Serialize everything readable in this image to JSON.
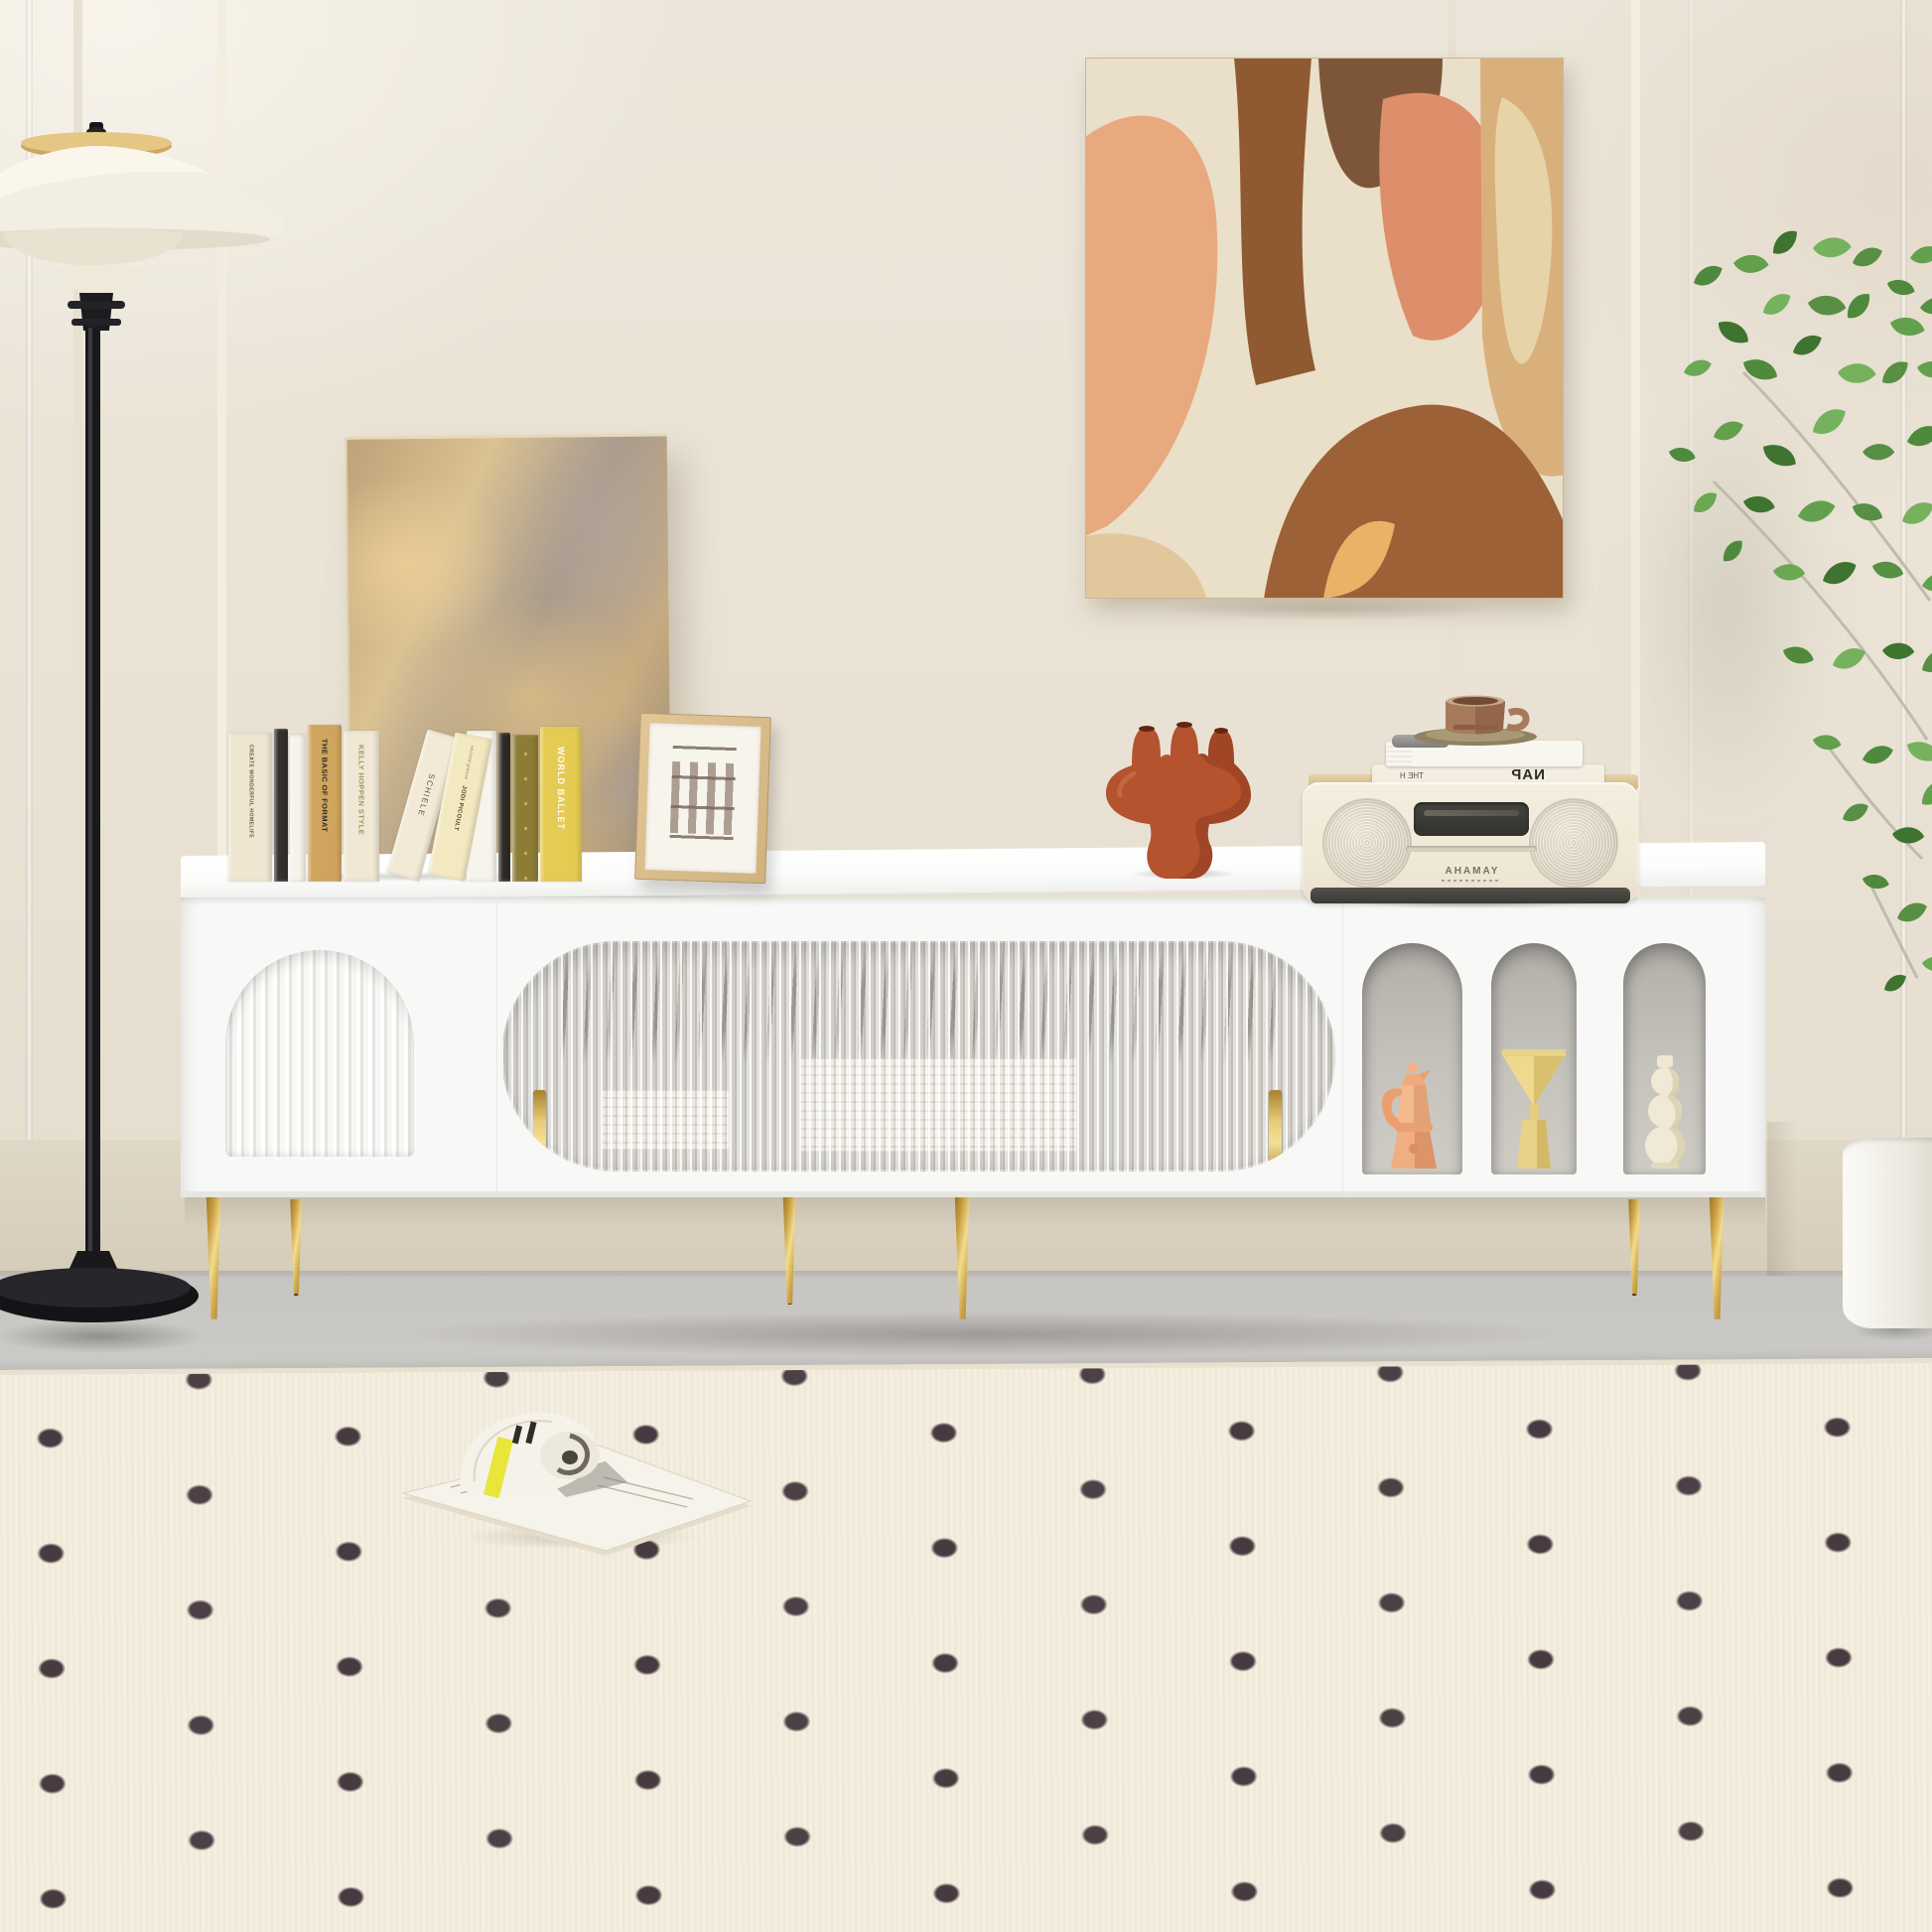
{
  "scene_label": "Bright living room with white TV stand, gold legs and styled decor",
  "palette": {
    "wall": "#eae3d6",
    "lower_wall": "#dbd2c1",
    "floor": "#cfcdc9",
    "rug": "#f3ecdc",
    "rug_dot": "#3e3138",
    "stand_white": "#f8f8f7",
    "gold": "#d3ab52",
    "reeded_glass": "#d2cfc9",
    "niche_grey": "#bcb9b3",
    "terracotta_vase": "#b4532e",
    "moka_peach": "#f2b186",
    "vase_yellow": "#e9d78e",
    "vase_cream": "#efe8d3",
    "plant_green": "#5d9a48",
    "lamp_black": "#1b1b1e",
    "lamp_shade_cream": "#f3eee2",
    "brass": "#c8a25a",
    "radio_cream": "#f2ecdc",
    "magazine_band": "#e9e432"
  },
  "books": [
    {
      "title": "CREATE WONDERFUL HOMELIFE",
      "color": "#efe6d2"
    },
    {
      "title": "",
      "color": "#34302c"
    },
    {
      "title": "",
      "color": "#f6f3ea"
    },
    {
      "title": "THE BASIC OF FORMAT",
      "color": "#cfa55e"
    },
    {
      "title": "KELLY HOPPEN STYLE",
      "color": "#f0e8d4"
    },
    {
      "title": "SCHIELE",
      "color": "#f2ead6"
    },
    {
      "title": "JODI PICOULT",
      "subtitle": "second glance",
      "color": "#f3e9c0"
    },
    {
      "title": "",
      "color": "#f7f4ec"
    },
    {
      "title": "",
      "color": "#2f2b27"
    },
    {
      "title": "",
      "color": "#8c7c35"
    },
    {
      "title": "WORLD BALLET",
      "color": "#e6cb52"
    }
  ],
  "radio": {
    "brand": "YAMAHA",
    "brand_mirrored": true,
    "stacked_books": [
      {
        "title": "NAP",
        "side_text": "THE H",
        "mirrored": true
      }
    ]
  },
  "frame": {
    "content": "architectural facade sketch"
  },
  "decor": {
    "terracotta_vase": "three-spout sculptural vase",
    "coffee_cup": "brown cup on saucer",
    "niche_items": [
      "moka pot",
      "triangle vase",
      "gourd vase"
    ],
    "magazine": "open magazine with yellow band",
    "plant": "leafy green tree",
    "planter": "white cylinder pot"
  },
  "tv_stand": {
    "finish": "white",
    "left_door": "fluted arch panel",
    "center_doors": "reeded glass with gold handles",
    "right_niches": 3,
    "legs": "gold tapered with black tips"
  }
}
